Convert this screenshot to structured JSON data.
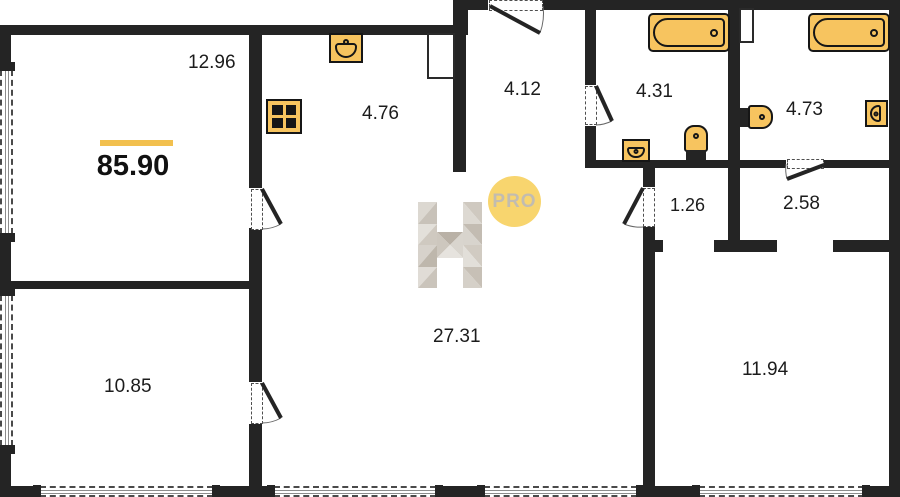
{
  "plan": {
    "total_area": "85.90",
    "rooms": [
      {
        "area": "12.96"
      },
      {
        "area": "4.76"
      },
      {
        "area": "4.12"
      },
      {
        "area": "4.31"
      },
      {
        "area": "4.73"
      },
      {
        "area": "1.26"
      },
      {
        "area": "2.58"
      },
      {
        "area": "27.31"
      },
      {
        "area": "10.85"
      },
      {
        "area": "11.94"
      }
    ],
    "watermark": {
      "letter": "H",
      "badge": "PRO"
    },
    "fixtures": [
      "stove",
      "kitchen-sink",
      "bathtub",
      "bathtub",
      "washbasin",
      "toilet",
      "toilet",
      "washbasin"
    ],
    "colors": {
      "wall": "#242424",
      "fixture_fill": "#f7c45f",
      "fixture_outline": "#161616",
      "accent_bar": "#f2c04e",
      "badge_fill": "#f8d56e",
      "badge_text": "#c2bcb0",
      "logo_grays": [
        "#e3e0da",
        "#d2ccc4",
        "#c0b9ae"
      ]
    }
  }
}
